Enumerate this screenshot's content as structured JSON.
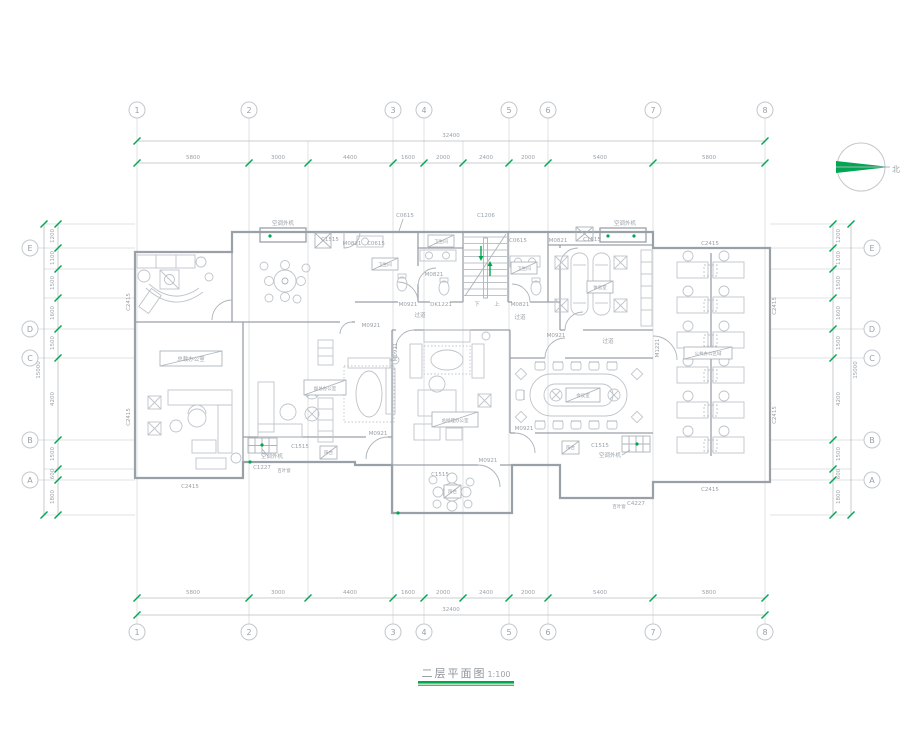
{
  "title": {
    "text": "二层平面图",
    "scale": "1:100"
  },
  "north_label": "北",
  "grid": {
    "cols": [
      "1",
      "2",
      "3",
      "4",
      "5",
      "6",
      "7",
      "8"
    ],
    "rows": [
      "E",
      "D",
      "C",
      "B",
      "A"
    ],
    "h_dims": [
      "5800",
      "3000",
      "4400",
      "1600",
      "2000",
      "2400",
      "2000",
      "5400",
      "5800"
    ],
    "h_total": "32400",
    "v_dims": [
      "1200",
      "1100",
      "1500",
      "1600",
      "1500",
      "4200",
      "1500",
      "600",
      "1800"
    ],
    "v_total": "15000"
  },
  "codes": {
    "c1515": "C1515",
    "c2415": "C2415",
    "c0615": "C0615",
    "c1206": "C1206",
    "c1227": "C1227",
    "c4227": "C4227",
    "m0821": "M0821",
    "m0921": "M0921",
    "m1221": "M1221",
    "dk1221": "DK1221"
  },
  "rooms": {
    "president": "总裁办公室",
    "vice_president": "副总办公室",
    "general_manager": "总经理办公室",
    "meeting": "会议室",
    "toilet": "卫生间",
    "lounge": "休息室",
    "open_office": "公共办公区域",
    "corridor": "过道",
    "balcony": "阳台"
  },
  "misc": {
    "ac_unit": "空调外机",
    "louver": "百叶窗",
    "stair_up": "上",
    "stair_down": "下"
  },
  "colors": {
    "green": "#00a651",
    "line": "#9aa0a7",
    "text": "#9aa1a8"
  }
}
